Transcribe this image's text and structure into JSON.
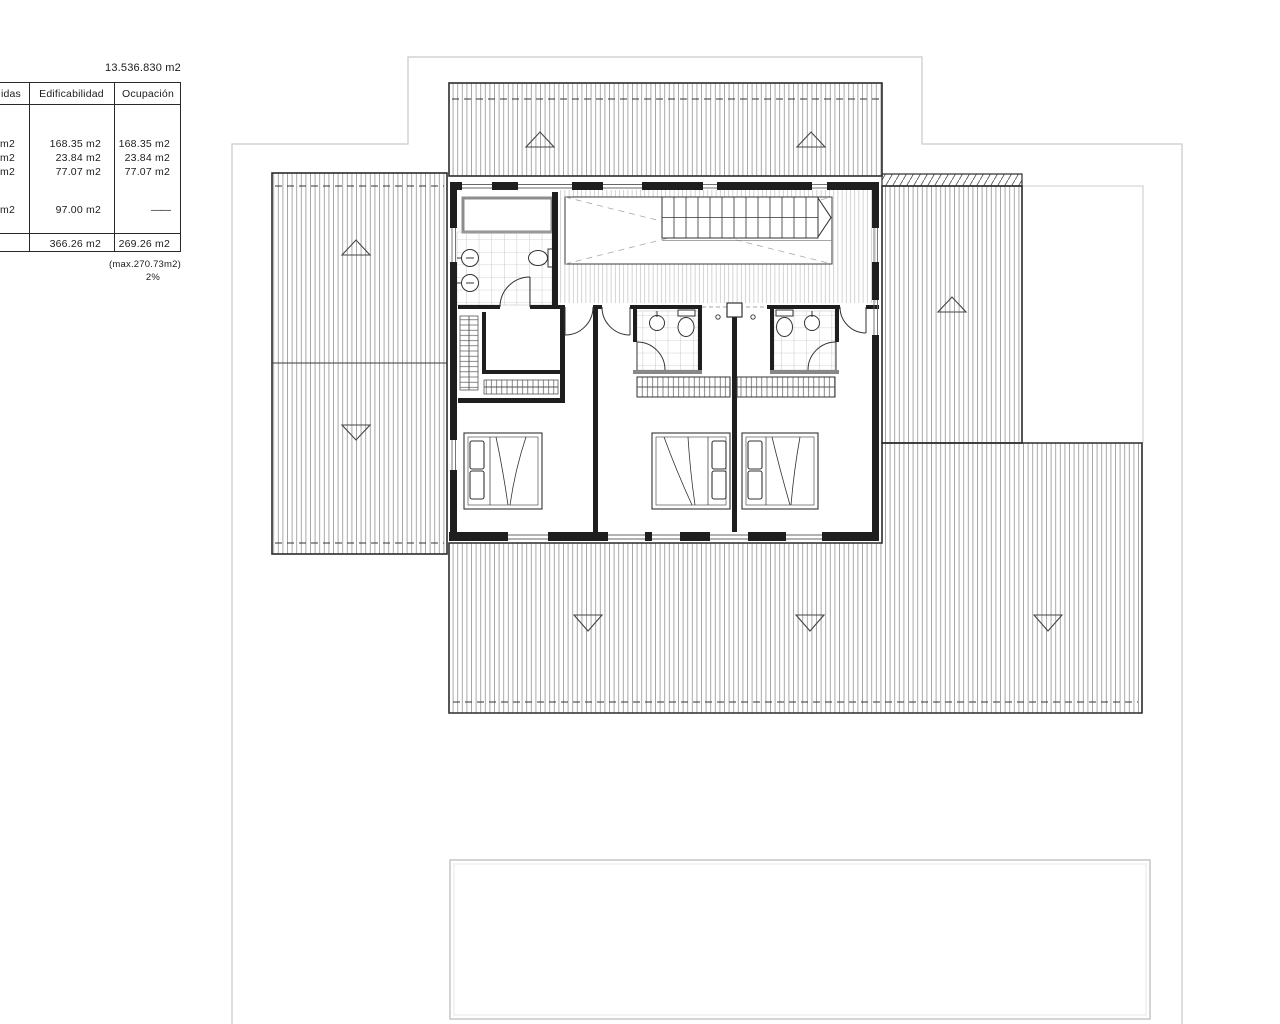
{
  "site": {
    "total_area_label": "13.536.830 m2"
  },
  "table": {
    "headers": {
      "col1_partial": "idas",
      "edificabilidad": "Edificabilidad",
      "ocupacion": "Ocupación"
    },
    "rows": [
      {
        "c1": "m2",
        "edificabilidad": "168.35 m2",
        "ocupacion": "168.35 m2"
      },
      {
        "c1": "m2",
        "edificabilidad": "23.84 m2",
        "ocupacion": "23.84 m2"
      },
      {
        "c1": "m2",
        "edificabilidad": "77.07 m2",
        "ocupacion": "77.07 m2"
      },
      {
        "c1": "m2",
        "edificabilidad": "97.00 m2",
        "ocupacion": "——"
      }
    ],
    "totals": {
      "edificabilidad": "366.26 m2",
      "ocupacion": "269.26 m2"
    },
    "notes": {
      "max": "(max.270.73m2)",
      "percent": "2%"
    }
  }
}
